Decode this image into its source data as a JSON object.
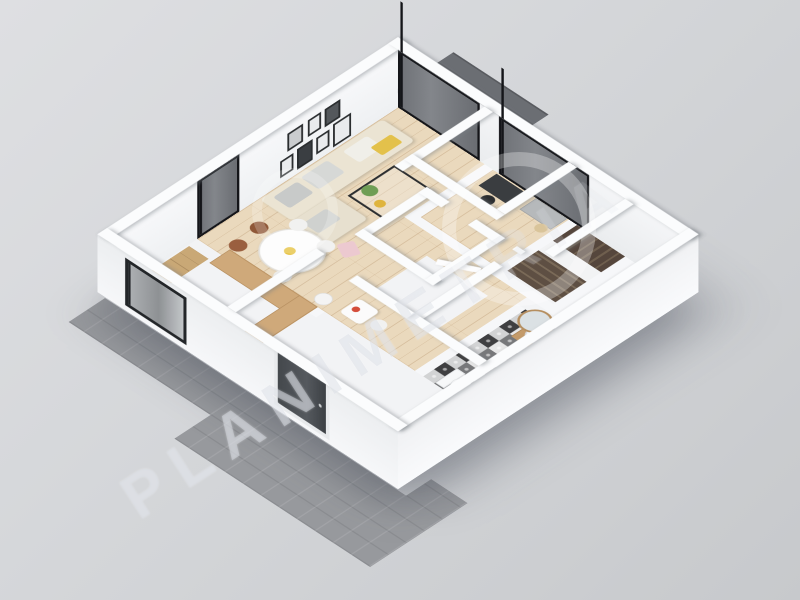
{
  "meta": {
    "description": "3D isometric floor plan render of a one-bedroom apartment on a gray studio background",
    "render_type": "3d-floor-plan"
  },
  "watermark": {
    "text": "PLANIMETRIA"
  },
  "rooms": [
    "living-room",
    "dining-area",
    "kitchen",
    "hallway",
    "wc",
    "bedroom",
    "staircase",
    "bathroom",
    "entry-vestibule",
    "terrace"
  ],
  "colors": {
    "background_top": "#dedfe2",
    "background_bottom": "#c7c9cc",
    "walls": "#fbfcfd",
    "wood_floor": "#ead9bd",
    "kitchen_counter_wood": "#cfa97a",
    "sofa_beige": "#ebe4d3",
    "window_glass_dark": "#6f7277",
    "window_frame_black": "#141519",
    "stair_wood_dark": "#5e4f43",
    "terrace_deck_gray": "#6b6e73",
    "outdoor_pavers_gray": "#97999d",
    "bathroom_tile_dark": "#3f3f41",
    "bathroom_tile_light": "#e8e8e8",
    "vanity_wood": "#c49b6a",
    "entry_door_charcoal": "#44484c",
    "accent_yellow": "#e3c14b",
    "accent_green": "#6f9e55",
    "accent_pink": "#ecc9d0",
    "accent_red_flowers": "#d44d3a",
    "sideboard_gray": "#b6b9bb",
    "chair_brown": "#9a5f3f"
  }
}
